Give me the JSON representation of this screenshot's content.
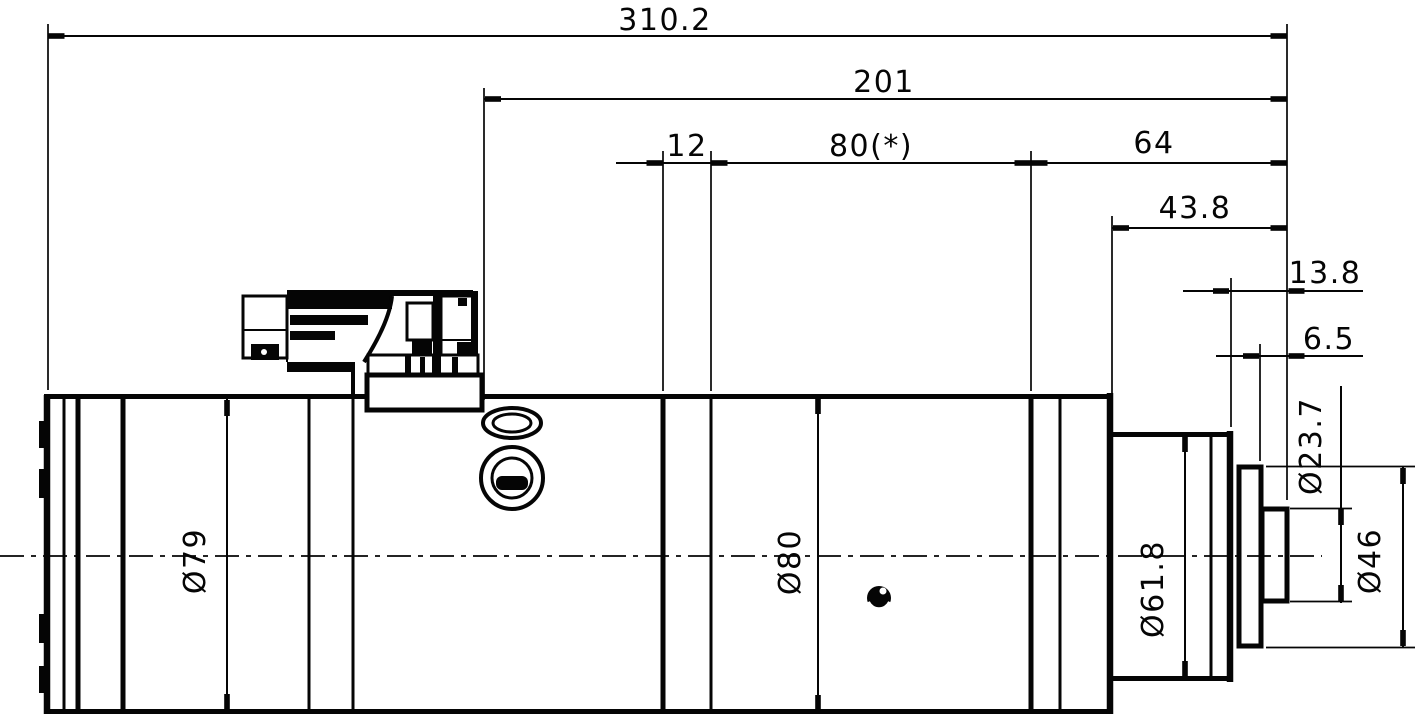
{
  "drawing": {
    "type": "technical-dimension-drawing",
    "view": "spindle-motor-side-view",
    "background_color": "#ffffff",
    "line_color": "#050505",
    "dims_horizontal": {
      "overall_length": "310.2",
      "front_length": "201",
      "groove_width": "12",
      "mid_section": "80(*)",
      "front_section": "64",
      "nose_length": "43.8",
      "tip_to_shoulder": "13.8",
      "tip_protrusion": "6.5"
    },
    "dims_diameter": {
      "rear_body": "Ø79",
      "main_body": "Ø80",
      "nose": "Ø61.8",
      "shaft_tip": "Ø23.7",
      "front_flange": "Ø46"
    }
  }
}
